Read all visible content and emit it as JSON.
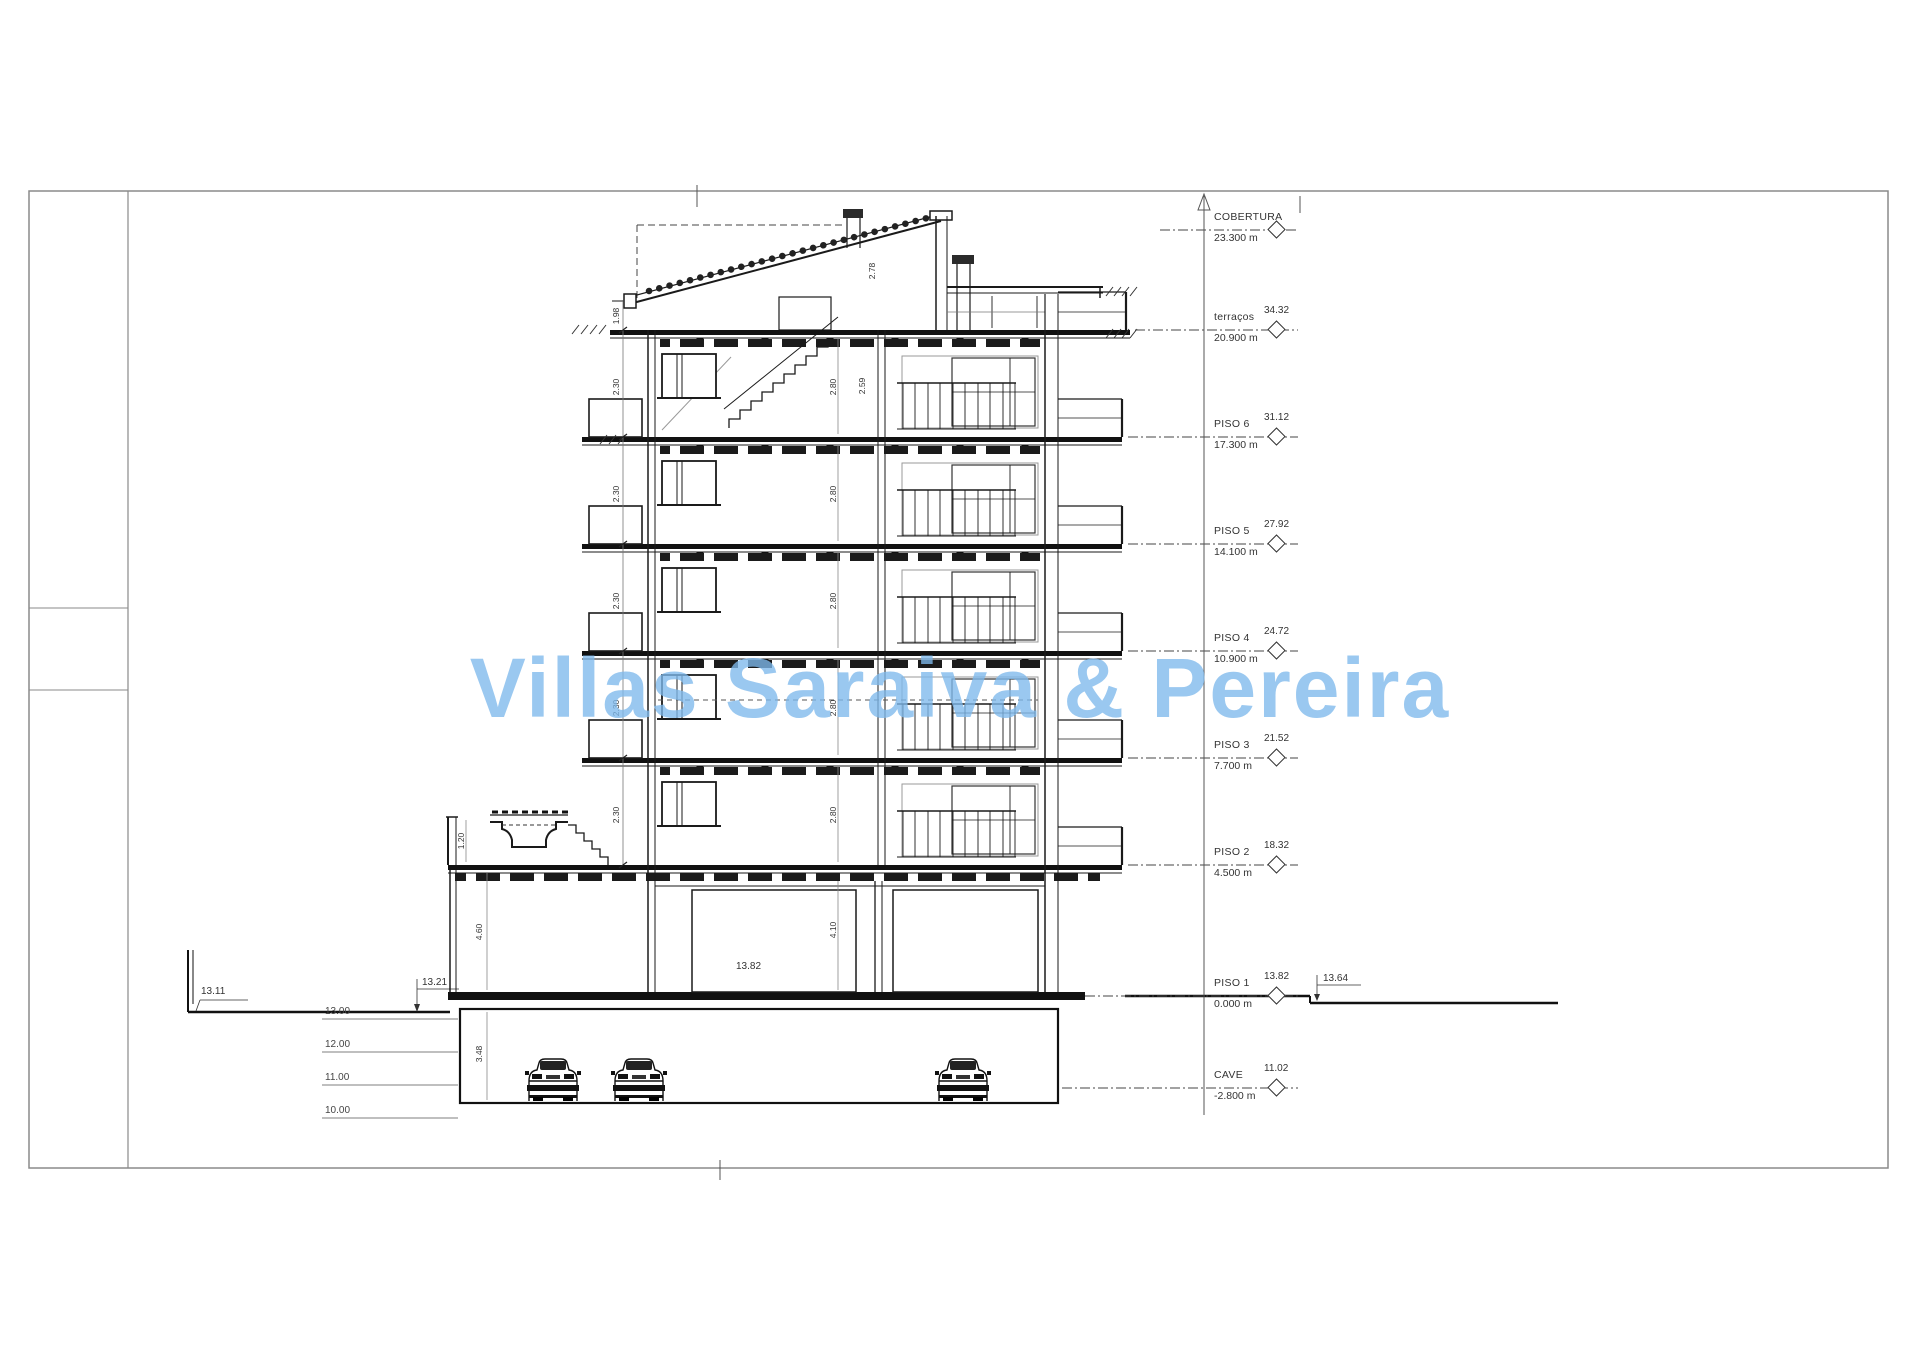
{
  "drawing": {
    "watermark": "Villas Saraiva & Pereira",
    "watermark_color": "#7db9ec",
    "levels": [
      {
        "label": "COBERTURA",
        "elevation": "23.300 m",
        "abs": ""
      },
      {
        "label": "terraços",
        "elevation": "20.900 m",
        "abs": "34.32"
      },
      {
        "label": "PISO 6",
        "elevation": "17.300 m",
        "abs": "31.12"
      },
      {
        "label": "PISO 5",
        "elevation": "14.100 m",
        "abs": "27.92"
      },
      {
        "label": "PISO 4",
        "elevation": "10.900 m",
        "abs": "24.72"
      },
      {
        "label": "PISO 3",
        "elevation": "7.700 m",
        "abs": "21.52"
      },
      {
        "label": "PISO 2",
        "elevation": "4.500 m",
        "abs": "18.32"
      },
      {
        "label": "PISO 1",
        "elevation": "0.000 m",
        "abs": "13.82"
      },
      {
        "label": "CAVE",
        "elevation": "-2.800 m",
        "abs": "11.02"
      }
    ],
    "ground_markers": [
      "13.11",
      "13.21",
      "13.82",
      "13.64"
    ],
    "elevation_refs": [
      "13.00",
      "12.00",
      "11.00",
      "10.00"
    ],
    "dims": [
      "2.80",
      "2.80",
      "2.80",
      "2.80",
      "2.80",
      "4.10",
      "2.30",
      "2.30",
      "2.30",
      "2.30",
      "2.30",
      "1.98",
      "2.78",
      "2.59",
      "3.48",
      "4.60",
      "1.20"
    ]
  }
}
